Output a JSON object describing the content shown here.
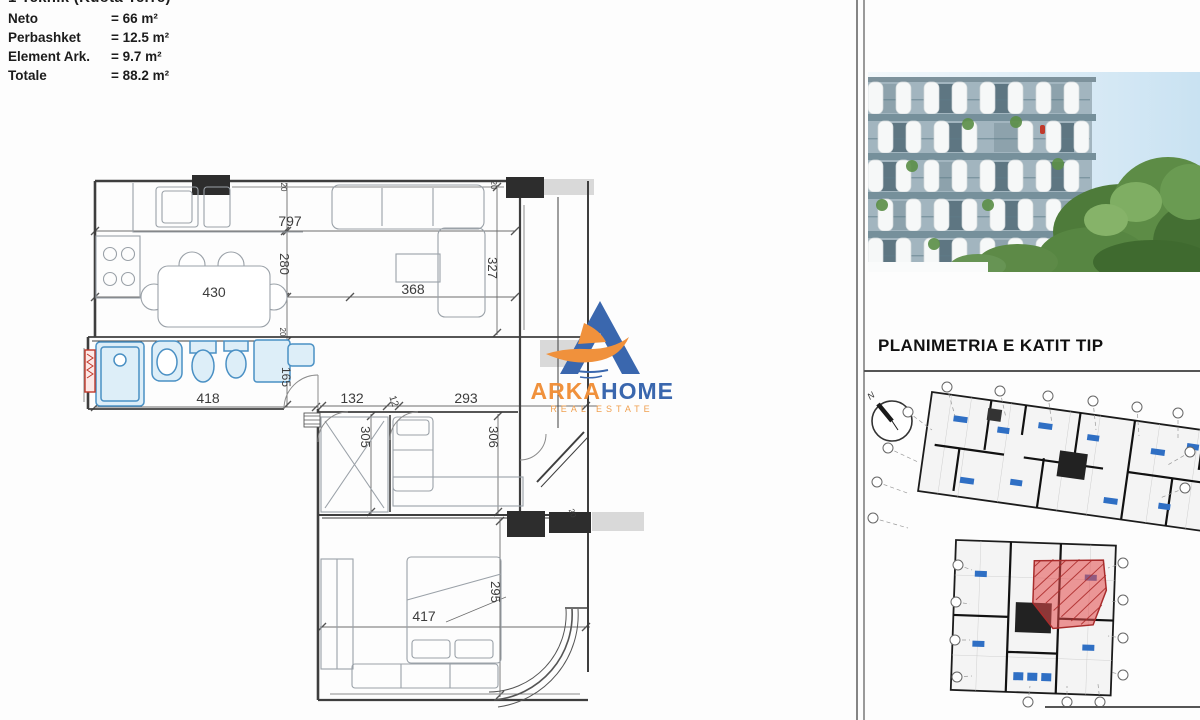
{
  "page_title_clipped": "1 Teknik (Kuota Terre)",
  "area_summary": {
    "rows": [
      {
        "label": "Neto",
        "value": "= 66 m²"
      },
      {
        "label": "Perbashket",
        "value": "= 12.5 m²"
      },
      {
        "label": "Element Ark.",
        "value": "= 9.7 m²"
      },
      {
        "label": "Totale",
        "value": "= 88.2 m²"
      }
    ]
  },
  "brand": {
    "name_primary": "ARKA",
    "name_secondary": "HOME",
    "tagline": "REAL ESTATE",
    "blue": "#3a67ae",
    "orange": "#f0913c"
  },
  "floor_plan": {
    "dimension_labels": [
      {
        "value": "797",
        "x": 290,
        "y": 226,
        "rot": 0,
        "size": 14
      },
      {
        "value": "280",
        "x": 280,
        "y": 264,
        "rot": 90,
        "size": 13
      },
      {
        "value": "430",
        "x": 214,
        "y": 297,
        "rot": 0,
        "size": 14
      },
      {
        "value": "368",
        "x": 413,
        "y": 294,
        "rot": 0,
        "size": 14
      },
      {
        "value": "327",
        "x": 488,
        "y": 268,
        "rot": 90,
        "size": 13
      },
      {
        "value": "418",
        "x": 208,
        "y": 403,
        "rot": 0,
        "size": 14
      },
      {
        "value": "165",
        "x": 282,
        "y": 377,
        "rot": 90,
        "size": 12
      },
      {
        "value": "132",
        "x": 352,
        "y": 403,
        "rot": 0,
        "size": 14
      },
      {
        "value": "12",
        "x": 391,
        "y": 402,
        "rot": 72,
        "size": 10
      },
      {
        "value": "293",
        "x": 466,
        "y": 403,
        "rot": 0,
        "size": 14
      },
      {
        "value": "305",
        "x": 361,
        "y": 437,
        "rot": 90,
        "size": 13
      },
      {
        "value": "306",
        "x": 489,
        "y": 437,
        "rot": 90,
        "size": 13
      },
      {
        "value": "417",
        "x": 424,
        "y": 621,
        "rot": 0,
        "size": 14
      },
      {
        "value": "295",
        "x": 491,
        "y": 592,
        "rot": 90,
        "size": 13
      },
      {
        "value": "20",
        "x": 281,
        "y": 187,
        "rot": 90,
        "size": 8
      },
      {
        "value": "20",
        "x": 280,
        "y": 332,
        "rot": 90,
        "size": 8
      },
      {
        "value": "20",
        "x": 491,
        "y": 185,
        "rot": 90,
        "size": 8
      },
      {
        "value": "20",
        "x": 570,
        "y": 514,
        "rot": 70,
        "size": 8
      }
    ],
    "accent_colors": {
      "fixtures_blue": "#4a90c4",
      "radiator_red": "#c0392b",
      "column_black": "#2d2d2d"
    }
  },
  "right_panel": {
    "heading": "PLANIMETRIA E KATIT TIP",
    "compass_label": "N",
    "highlight_color": "#e04848"
  }
}
